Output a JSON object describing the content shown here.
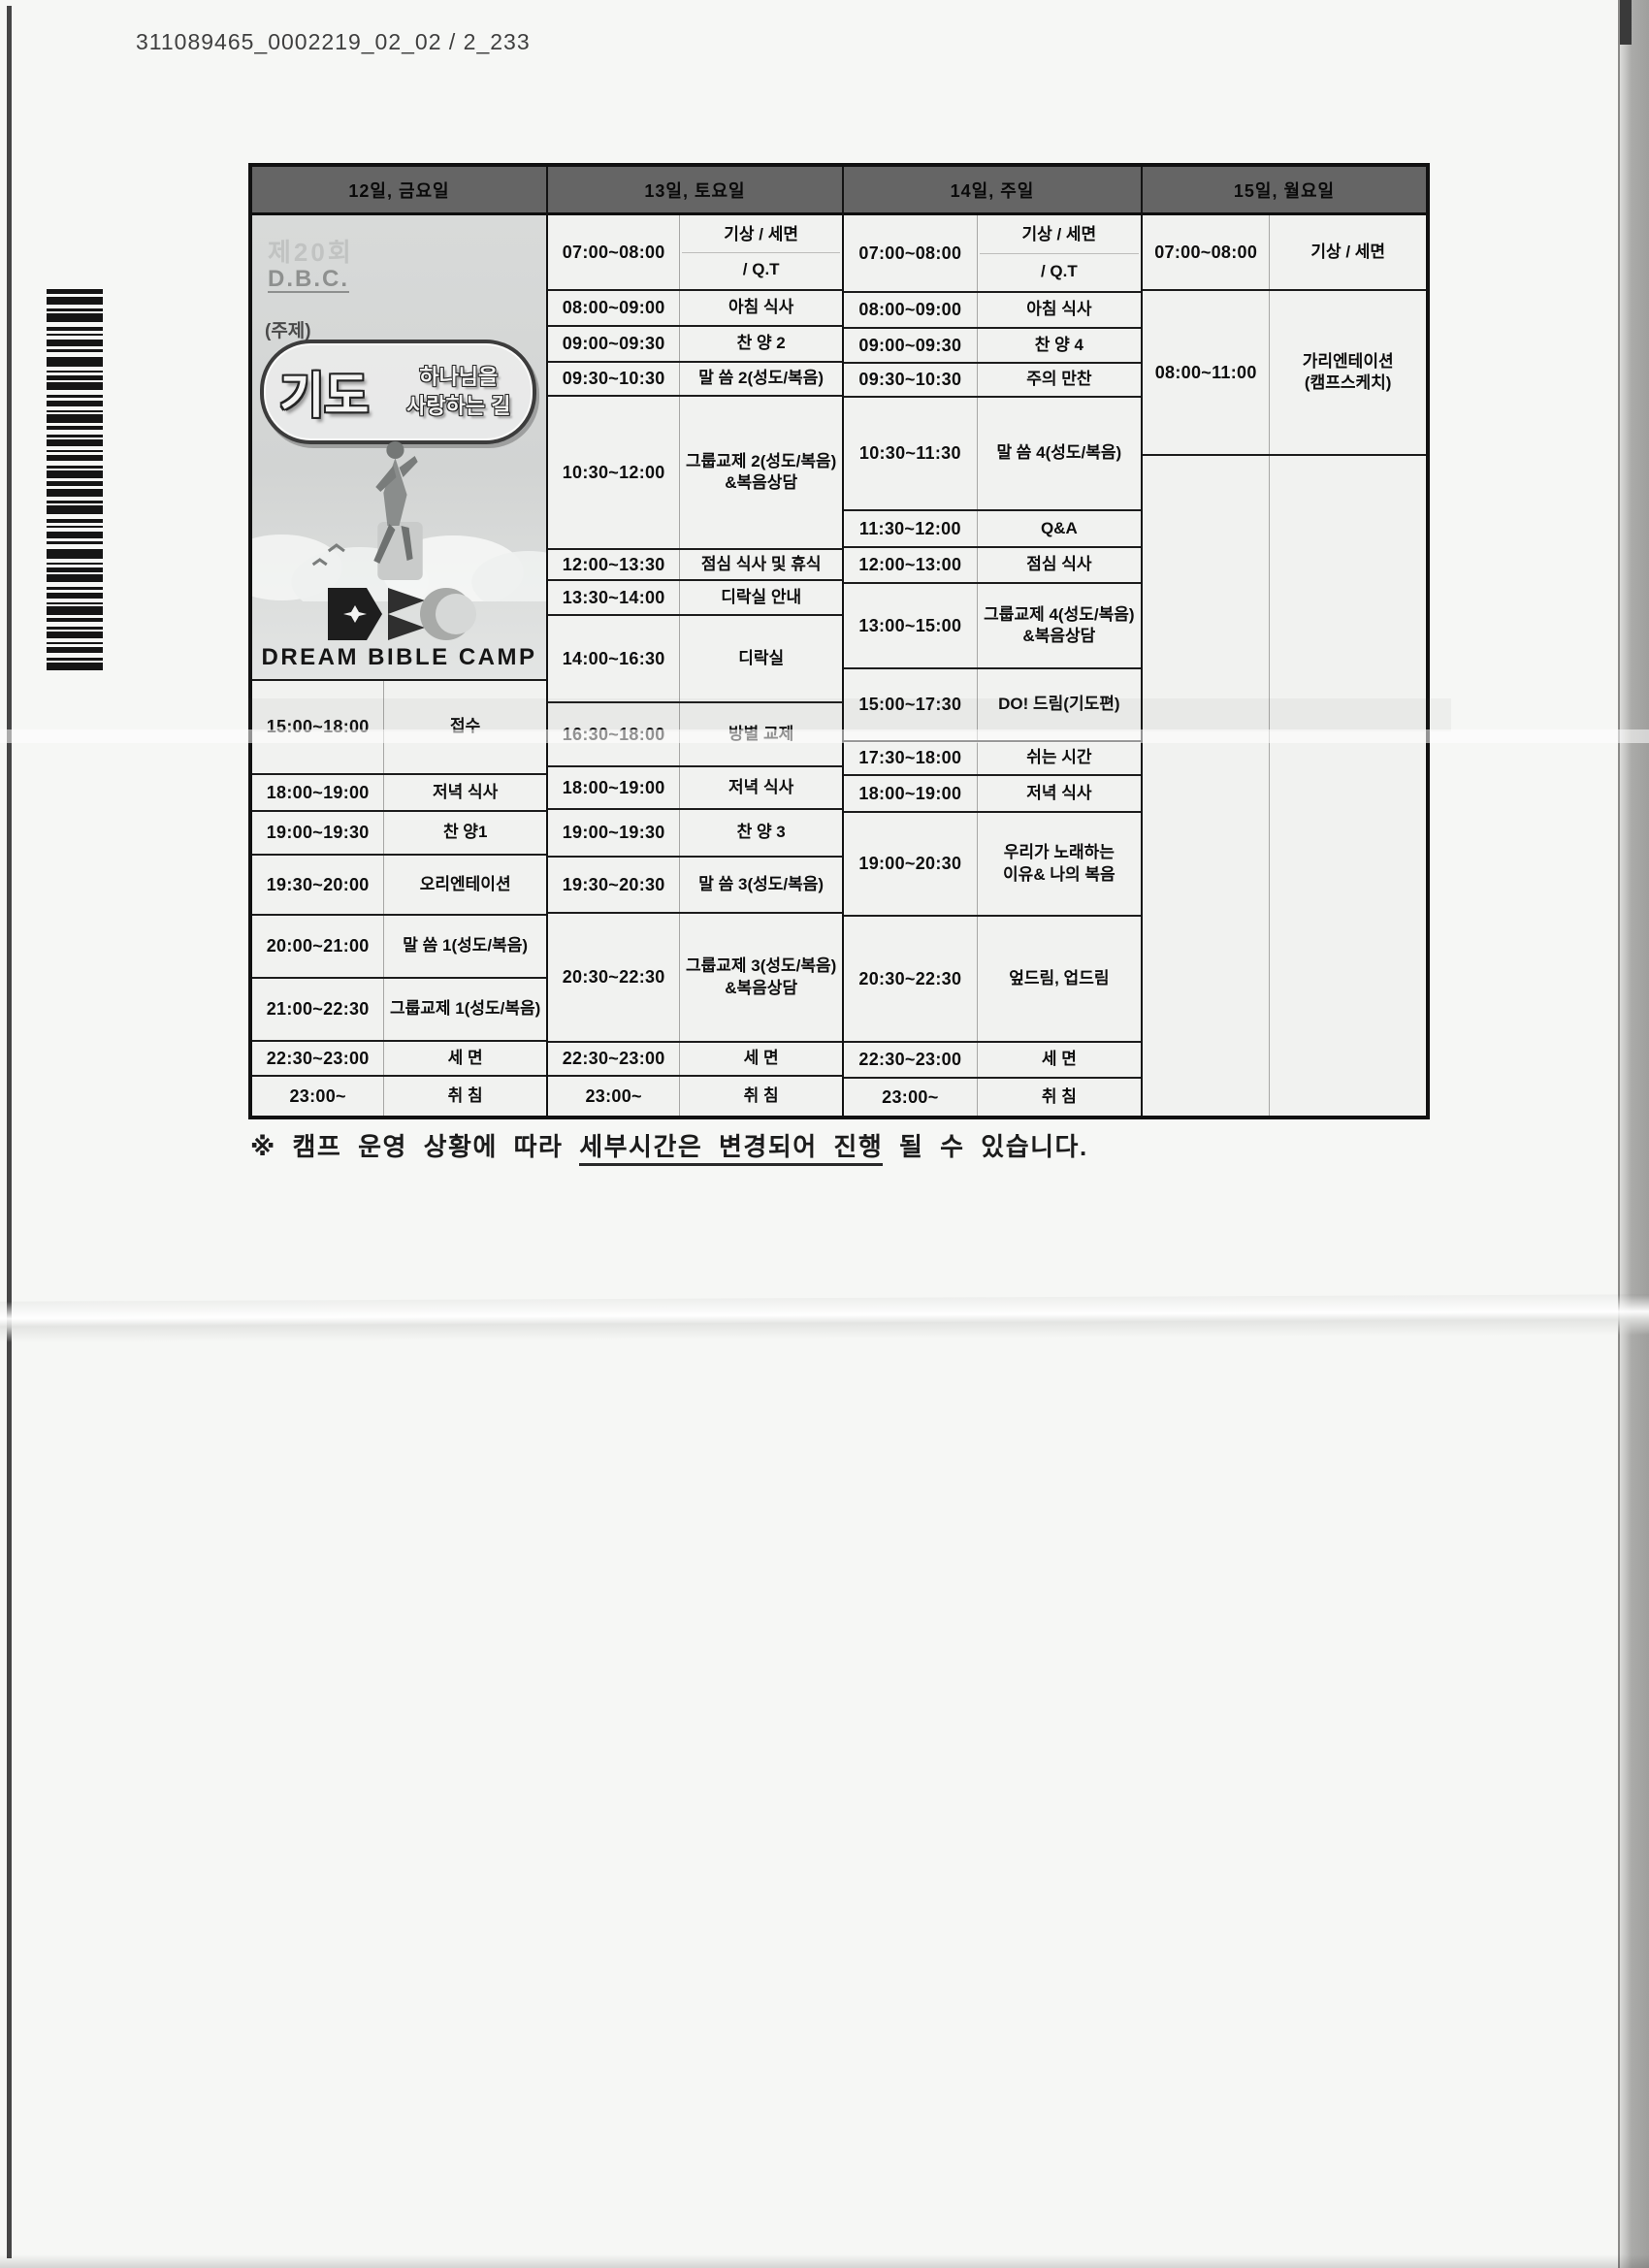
{
  "page": {
    "scan_id": "311089465_0002219_02_02 / 2_233",
    "note": {
      "prefix": "※ 캠프 운영 상황에 따라 ",
      "underlined": "세부시간은 변경되어 진행",
      "suffix": " 될 수 있습니다."
    }
  },
  "logo": {
    "edition": "제20회",
    "abbr": "D.B.C.",
    "theme_label": "(주제)",
    "theme_word": "기도",
    "theme_line1": "하나님을",
    "theme_line2": "사랑하는 길",
    "camp_name": "DREAM BIBLE CAMP"
  },
  "schedule": {
    "columns": [
      {
        "header": "12일, 금요일",
        "rows": [
          {
            "time": "15:00~18:00",
            "activity": "접수"
          },
          {
            "time": "18:00~19:00",
            "activity": "저녁 식사"
          },
          {
            "time": "19:00~19:30",
            "activity": "찬 양1"
          },
          {
            "time": "19:30~20:00",
            "activity": "오리엔테이션"
          },
          {
            "time": "20:00~21:00",
            "activity": "말 씀 1(성도/복음)"
          },
          {
            "time": "21:00~22:30",
            "activity": "그룹교제 1(성도/복음)"
          },
          {
            "time": "22:30~23:00",
            "activity": "세 면"
          },
          {
            "time": "23:00~",
            "activity": "취 침"
          }
        ]
      },
      {
        "header": "13일, 토요일",
        "rows": [
          {
            "time": "07:00~08:00",
            "activity": "기상 / 세면",
            "activity2": "/ Q.T"
          },
          {
            "time": "08:00~09:00",
            "activity": "아침 식사"
          },
          {
            "time": "09:00~09:30",
            "activity": "찬 양 2"
          },
          {
            "time": "09:30~10:30",
            "activity": "말 씀 2(성도/복음)"
          },
          {
            "time": "10:30~12:00",
            "activity": "그룹교제 2(성도/복음)\n&복음상담"
          },
          {
            "time": "12:00~13:30",
            "activity": "점심 식사 및 휴식"
          },
          {
            "time": "13:30~14:00",
            "activity": "디락실 안내"
          },
          {
            "time": "14:00~16:30",
            "activity": "디락실"
          },
          {
            "time": "16:30~18:00",
            "activity": "방별 교제"
          },
          {
            "time": "18:00~19:00",
            "activity": "저녁 식사"
          },
          {
            "time": "19:00~19:30",
            "activity": "찬 양 3"
          },
          {
            "time": "19:30~20:30",
            "activity": "말 씀 3(성도/복음)"
          },
          {
            "time": "20:30~22:30",
            "activity": "그룹교제 3(성도/복음)\n&복음상담"
          },
          {
            "time": "22:30~23:00",
            "activity": "세 면"
          },
          {
            "time": "23:00~",
            "activity": "취 침"
          }
        ]
      },
      {
        "header": "14일, 주일",
        "rows": [
          {
            "time": "07:00~08:00",
            "activity": "기상 / 세면",
            "activity2": "/ Q.T"
          },
          {
            "time": "08:00~09:00",
            "activity": "아침 식사"
          },
          {
            "time": "09:00~09:30",
            "activity": "찬 양 4"
          },
          {
            "time": "09:30~10:30",
            "activity": "주의 만찬"
          },
          {
            "time": "10:30~11:30",
            "activity": "말 씀 4(성도/복음)"
          },
          {
            "time": "11:30~12:00",
            "activity": "Q&A"
          },
          {
            "time": "12:00~13:00",
            "activity": "점심 식사"
          },
          {
            "time": "13:00~15:00",
            "activity": "그룹교제 4(성도/복음)\n&복음상담"
          },
          {
            "time": "15:00~17:30",
            "activity": "DO! 드림(기도편)"
          },
          {
            "time": "17:30~18:00",
            "activity": "쉬는 시간"
          },
          {
            "time": "18:00~19:00",
            "activity": "저녁 식사"
          },
          {
            "time": "19:00~20:30",
            "activity": "우리가 노래하는\n이유& 나의 복음"
          },
          {
            "time": "20:30~22:30",
            "activity": "엎드림, 업드림"
          },
          {
            "time": "22:30~23:00",
            "activity": "세 면"
          },
          {
            "time": "23:00~",
            "activity": "취 침"
          }
        ]
      },
      {
        "header": "15일, 월요일",
        "rows": [
          {
            "time": "07:00~08:00",
            "activity": "기상 / 세면"
          },
          {
            "time": "08:00~11:00",
            "activity": "가리엔테이션\n(캠프스케치)"
          },
          {
            "time": "",
            "activity": "",
            "filler": true
          }
        ]
      }
    ]
  }
}
